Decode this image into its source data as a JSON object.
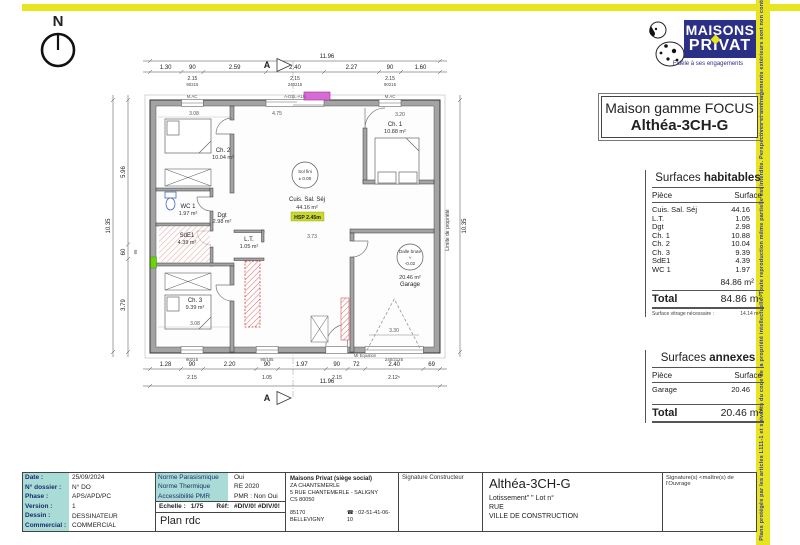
{
  "page": {
    "compass": "N",
    "side_strip_text": "Plans protégés par les articles L111-1 et suivants du code de la propriété intellectuelle. Toute reproduction même partielle est interdite. Perspectives et aménagements extérieurs sont non contractuels"
  },
  "logo": {
    "word1": "MAISONS",
    "word2": "PRIVAT",
    "tagline": "Fidèle à ses engagements"
  },
  "title_box": {
    "line1": "Maison gamme FOCUS",
    "line2": "Althéa-3CH-G"
  },
  "plan": {
    "section_marker": "A",
    "limite": "Limite de propriété",
    "dims": {
      "top_total": "11.96",
      "top": [
        "1.30",
        "90",
        "2.59",
        "2.40",
        "2.27",
        "90",
        "1.60"
      ],
      "top_sub_h": [
        "2.15",
        "2.15",
        "2.15"
      ],
      "top_sub_tag": [
        "90215",
        "240215",
        "90215"
      ],
      "bottom": [
        "1.28",
        "90",
        "2.20",
        "90",
        "1.97",
        "90",
        "72",
        "2.40",
        "69"
      ],
      "bottom_sub": [
        "2.15",
        "1.05",
        "2.15",
        "2.12⁵"
      ],
      "bottom_tags": [
        "90215",
        "90/105",
        "240/2125"
      ],
      "bottom_total": "11.96",
      "left": [
        "5.96",
        "60",
        "3.79"
      ],
      "left_extra": "95",
      "left_total": "10.35",
      "right_total": "10.35"
    },
    "interior_dims": {
      "ch2": "3.08",
      "living_top": "4.75",
      "ch1": "3.20",
      "living": "3.73",
      "ch3": "3.08",
      "garage": "3.30"
    },
    "rooms": {
      "ch2_name": "Ch. 2",
      "ch2_area": "10.04 m²",
      "wc1_name": "WC 1",
      "wc1_area": "1.97 m²",
      "sde1_name": "SdE1",
      "sde1_area": "4.39 m²",
      "dgt_name": "Dgt",
      "dgt_area": "2.98 m²",
      "ch3_name": "Ch. 3",
      "ch3_area": "9.39 m²",
      "lt_name": "L.T.",
      "lt_area": "1.05 m²",
      "cuis_name": "Cuis. Sal. Séj",
      "cuis_area": "44.16 m²",
      "cuis_hsp": "HSP 2.45m",
      "ch1_name": "Ch. 1",
      "ch1_area": "10.88 m²",
      "garage_area": "20.46 m²",
      "garage_name": "Garage"
    },
    "levels": {
      "sol1": "Sol fini",
      "sol2": "± 0.00",
      "dalle1": "Dalle brute",
      "dalle2": "≈",
      "dalle3": "-0.02"
    },
    "wall_tags": {
      "mac1": "M.AC",
      "mac2": "M.AC",
      "bay": "A-DSL-ALU",
      "entry": "MI Equation"
    }
  },
  "surfaces_habitables": {
    "title1": "Surfaces",
    "title2": "habitables",
    "col_piece": "Pièce",
    "col_surface": "Surface",
    "rows": [
      [
        "Cuis. Sal. Séj",
        "44.16"
      ],
      [
        "L.T.",
        "1.05"
      ],
      [
        "Dgt",
        "2.98"
      ],
      [
        "Ch. 1",
        "10.88"
      ],
      [
        "Ch. 2",
        "10.04"
      ],
      [
        "Ch. 3",
        "9.39"
      ],
      [
        "SdE1",
        "4.39"
      ],
      [
        "WC 1",
        "1.97"
      ]
    ],
    "subtotal": "84.86 m²",
    "total_label": "Total",
    "total_value": "84.86 m²",
    "footnote_label": "Surface vitrage nécessaire :",
    "footnote_value": "14.14 m²"
  },
  "surfaces_annexes": {
    "title1": "Surfaces",
    "title2": "annexes",
    "col_piece": "Pièce",
    "col_surface": "Surface",
    "rows": [
      [
        "Garage",
        "20.46"
      ]
    ],
    "total_label": "Total",
    "total_value": "20.46 m²"
  },
  "title_block": {
    "info_rows": [
      {
        "label": "Date :",
        "value": "25/09/2024"
      },
      {
        "label": "N° dossier :",
        "value": "N° DO"
      },
      {
        "label": "Phase :",
        "value": "APS/APD/PC"
      },
      {
        "label": "Version :",
        "value": "1"
      },
      {
        "label": "Dessin :",
        "value": "DESSINATEUR"
      },
      {
        "label": "Commercial :",
        "value": "COMMERCIAL"
      }
    ],
    "norm_rows": [
      {
        "label": "Norme Parasismique",
        "value": "Oui"
      },
      {
        "label": "Norme Thermique",
        "value": "RE 2020"
      },
      {
        "label": "Accessibilité PMR",
        "value": "PMR : Non Oui"
      }
    ],
    "echelle_label": "Echelle :",
    "echelle_value": "1/75",
    "ref_label": "Réf:",
    "ref_value": "#DIV/0!  #DIV/0!",
    "plan_name": "Plan rdc",
    "company": {
      "name": "Maisons Privat (siège social)",
      "addr1": "ZA CHANTEMERLE",
      "addr2": "5 RUE CHANTEMERLE - SALIGNY",
      "addr3": "CS 80050",
      "city": "85170 BELLEVIGNY",
      "phone": "☎ : 02-51-41-06-10"
    },
    "sig_constructeur": "Signature Constructeur",
    "project": {
      "name": "Althéa-3CH-G",
      "lot": "Lotissement\"   \" Lot n°",
      "rue": "RUE",
      "ville": "VILLE DE CONSTRUCTION"
    },
    "sig_owner": "Signature(s) <maître(s) de l'Ouvrage"
  }
}
